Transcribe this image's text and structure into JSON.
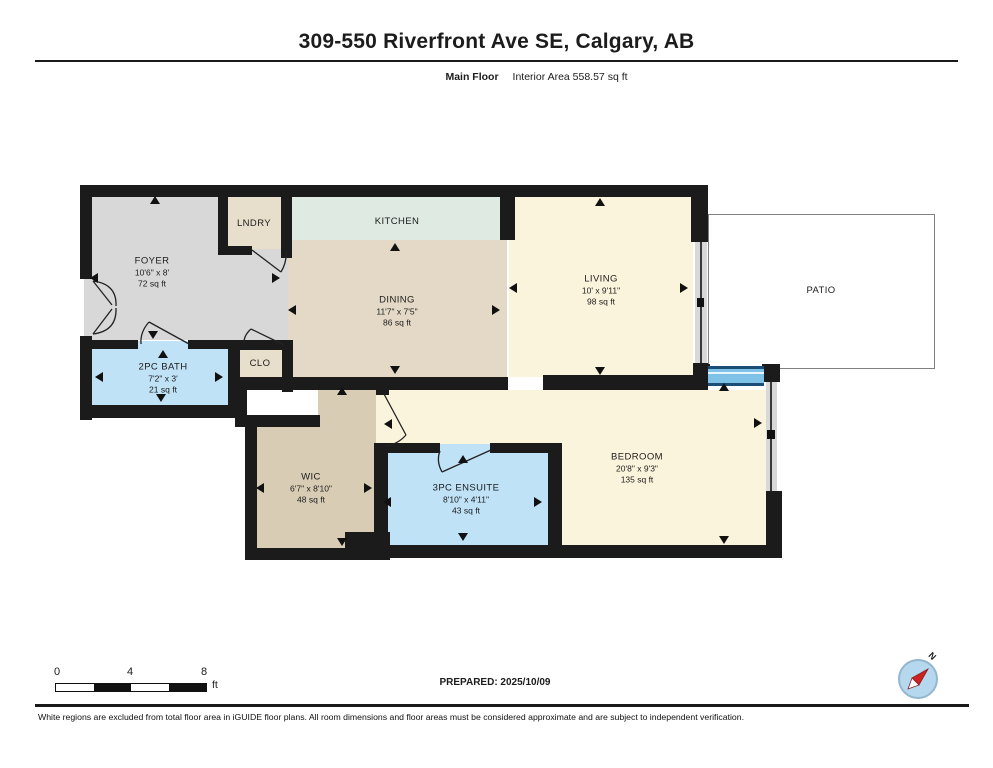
{
  "header": {
    "title": "309-550 Riverfront Ave SE, Calgary, AB",
    "floor_label": "Main Floor",
    "area_label": "Interior Area 558.57 sq ft"
  },
  "rooms": {
    "foyer": {
      "name": "FOYER",
      "dims": "10'6\" x 8'",
      "area": "72 sq ft"
    },
    "laundry": {
      "name": "LNDRY"
    },
    "kitchen": {
      "name": "KITCHEN"
    },
    "dining": {
      "name": "DINING",
      "dims": "11'7\" x 7'5\"",
      "area": "86 sq ft"
    },
    "living": {
      "name": "LIVING",
      "dims": "10' x 9'11\"",
      "area": "98 sq ft"
    },
    "patio": {
      "name": "PATIO"
    },
    "bath": {
      "name": "2PC BATH",
      "dims": "7'2\" x 3'",
      "area": "21 sq ft"
    },
    "closet": {
      "name": "CLO"
    },
    "wic": {
      "name": "WIC",
      "dims": "6'7\" x 8'10\"",
      "area": "48 sq ft"
    },
    "ensuite": {
      "name": "3PC ENSUITE",
      "dims": "8'10\" x 4'11\"",
      "area": "43 sq ft"
    },
    "bedroom": {
      "name": "BEDROOM",
      "dims": "20'8\" x 9'3\"",
      "area": "135 sq ft"
    }
  },
  "scale_bar": {
    "ticks": [
      "0",
      "4",
      "8"
    ],
    "unit": "ft"
  },
  "compass": {
    "north_label": "N"
  },
  "footer": {
    "prepared": "PREPARED: 2025/10/09",
    "disclaimer": "White regions are excluded from total floor area in iGUIDE floor plans. All room dimensions and floor areas must be considered approximate and are subject to independent verification."
  },
  "colors": {
    "wall": "#1b1b1b",
    "foyer_floor": "#d8d8d8",
    "wood_floor": "#e3d9c6",
    "kitchen_floor": "#dfeae3",
    "carpet_floor": "#fbf4dc",
    "bath_floor": "#bfe2f7",
    "window_blue": "#7fc2e8",
    "compass_blue": "#b5d8ee",
    "needle_red": "#cc2222"
  }
}
